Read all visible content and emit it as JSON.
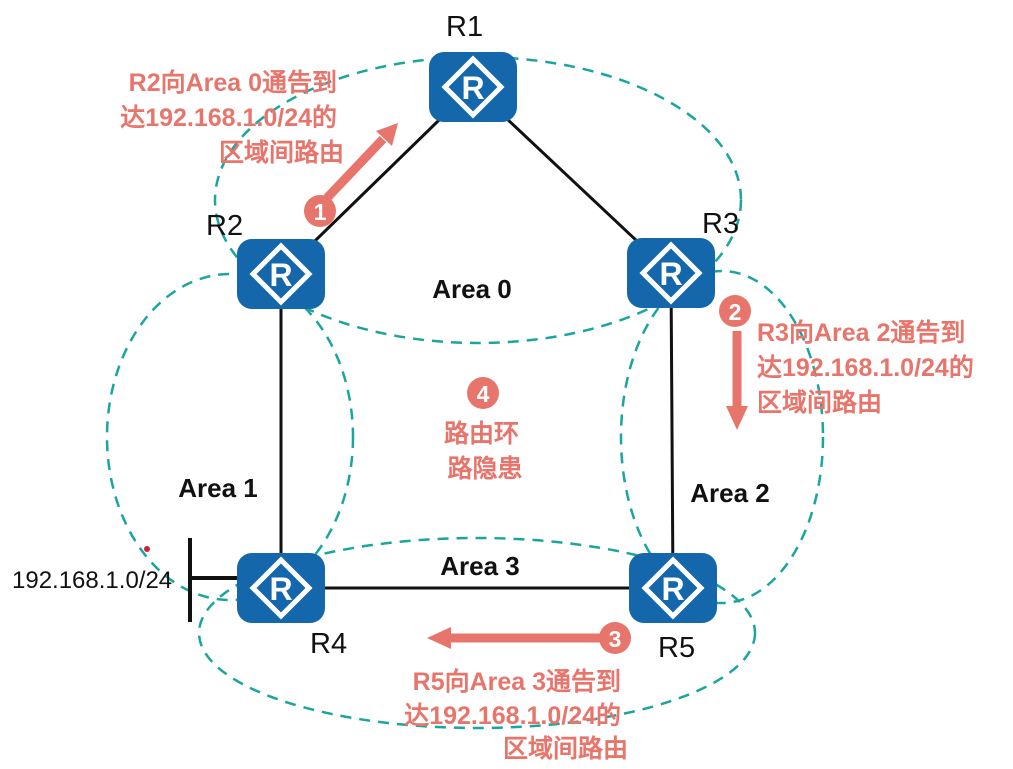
{
  "colors": {
    "router_blue": "#1467ab",
    "area_dash_teal": "#1aa59f",
    "annotation_salmon": "#e8756b",
    "ink": "#111111"
  },
  "router_icon_letter": "R",
  "routers": [
    {
      "label": "R1"
    },
    {
      "label": "R2"
    },
    {
      "label": "R3"
    },
    {
      "label": "R4"
    },
    {
      "label": "R5"
    }
  ],
  "areas": [
    {
      "label": "Area 0"
    },
    {
      "label": "Area 1"
    },
    {
      "label": "Area 2"
    },
    {
      "label": "Area 3"
    }
  ],
  "network_label": "192.168.1.0/24",
  "annotations": [
    {
      "badge": "1",
      "lines": [
        "R2向Area 0通告到",
        "达192.168.1.0/24的",
        "区域间路由"
      ]
    },
    {
      "badge": "2",
      "lines": [
        "R3向Area 2通告到",
        "达192.168.1.0/24的",
        "区域间路由"
      ]
    },
    {
      "badge": "3",
      "lines": [
        "R5向Area 3通告到",
        "达192.168.1.0/24的",
        "区域间路由"
      ]
    },
    {
      "badge": "4",
      "lines": [
        "路由环",
        "路隐患"
      ]
    }
  ]
}
